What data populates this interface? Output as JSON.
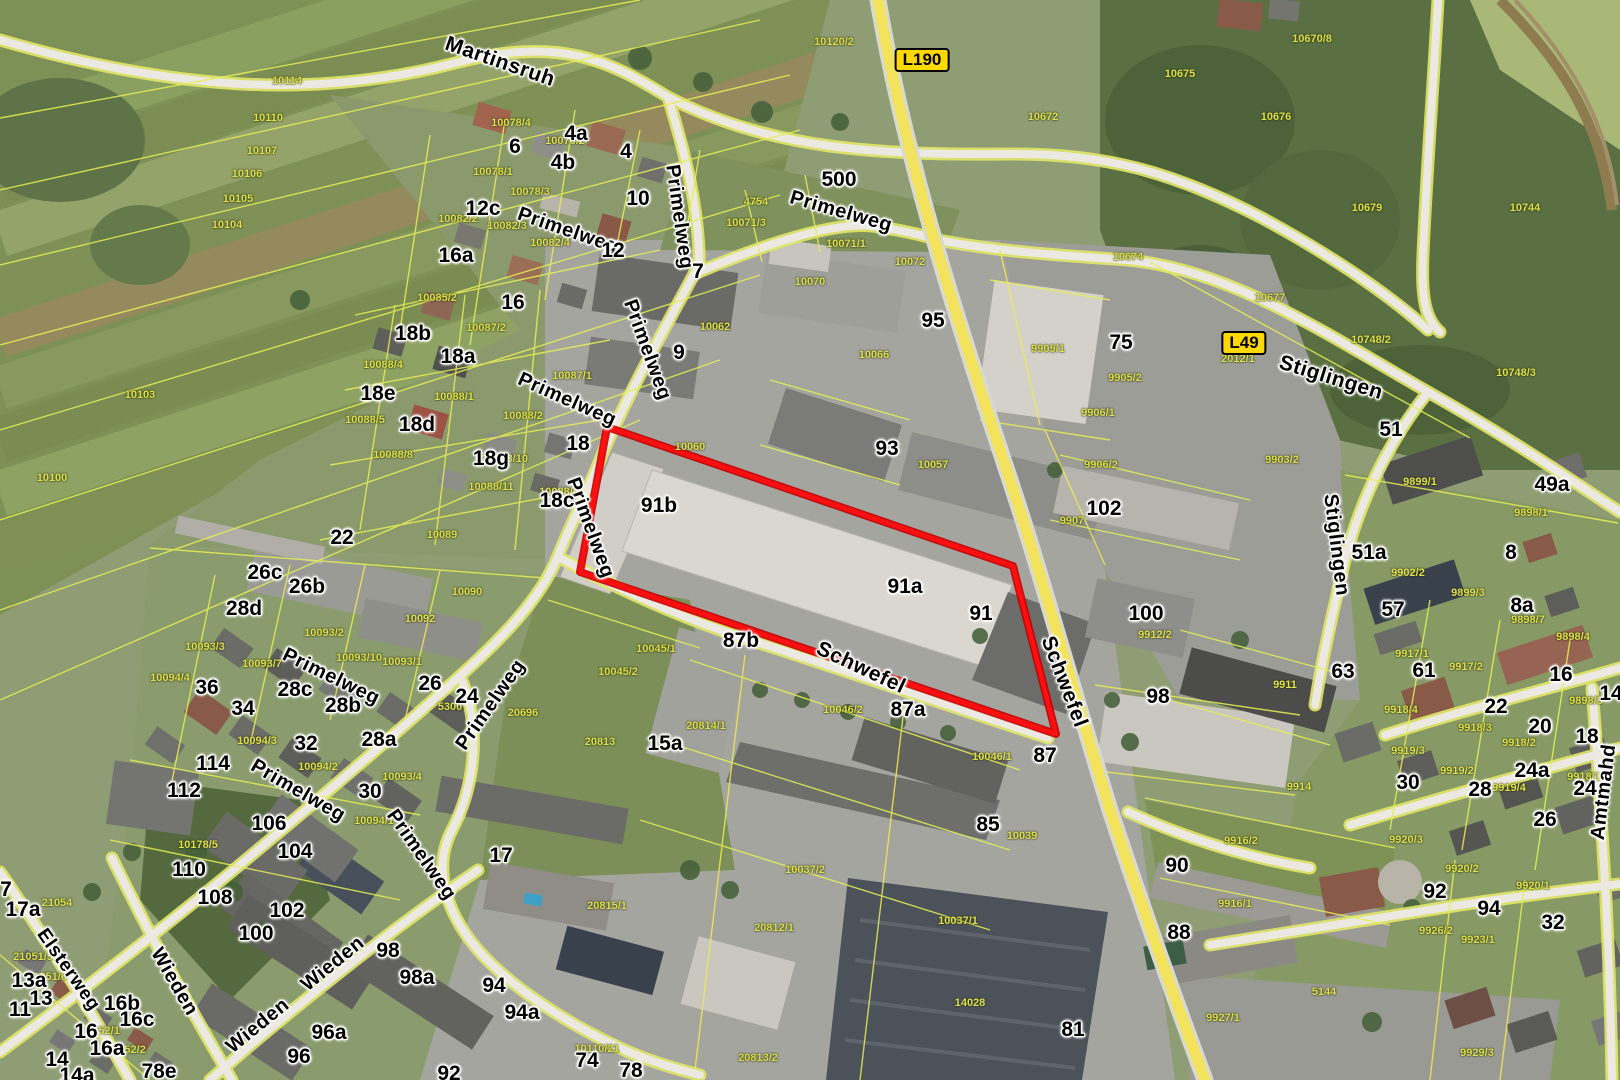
{
  "map": {
    "colors": {
      "cadastral_line": "#e6ee55",
      "red_outline": "#ff0f0f",
      "red_outline_dark": "#c40000",
      "major_road": "#f2e25c",
      "road_badge_bg": "#ffd800",
      "road_badge_text": "#000000",
      "parcel_label": "#dce24f",
      "label_halo": "#ffffff"
    },
    "highlight": {
      "points": "607,427 1013,566 1056,734 580,572"
    },
    "badges": [
      {
        "text": "L190",
        "x": 922,
        "y": 60
      },
      {
        "text": "L49",
        "x": 1244,
        "y": 343
      }
    ],
    "streets": [
      {
        "text": "Martinsruh",
        "x": 500,
        "y": 62,
        "rotate": 19,
        "size": 21
      },
      {
        "text": "Primelweg",
        "x": 568,
        "y": 231,
        "rotate": 19
      },
      {
        "text": "Primelweg",
        "x": 841,
        "y": 212,
        "rotate": 16
      },
      {
        "text": "Primelweg",
        "x": 679,
        "y": 217,
        "rotate": 82
      },
      {
        "text": "Primelweg",
        "x": 647,
        "y": 350,
        "rotate": 70
      },
      {
        "text": "Primelweg",
        "x": 567,
        "y": 400,
        "rotate": 24
      },
      {
        "text": "Primelweg",
        "x": 590,
        "y": 528,
        "rotate": 70
      },
      {
        "text": "Primelweg",
        "x": 331,
        "y": 677,
        "rotate": 26
      },
      {
        "text": "Primelweg",
        "x": 298,
        "y": 791,
        "rotate": 30
      },
      {
        "text": "Primelweg",
        "x": 491,
        "y": 705,
        "rotate": -55
      },
      {
        "text": "Primelweg",
        "x": 421,
        "y": 855,
        "rotate": 55
      },
      {
        "text": "Schwefel",
        "x": 861,
        "y": 668,
        "rotate": 25,
        "size": 21
      },
      {
        "text": "Schwefel",
        "x": 1064,
        "y": 682,
        "rotate": 69,
        "size": 21
      },
      {
        "text": "Stiglingen",
        "x": 1331,
        "y": 378,
        "rotate": 17,
        "size": 21
      },
      {
        "text": "Stiglingen",
        "x": 1336,
        "y": 545,
        "rotate": 83
      },
      {
        "text": "Wieden",
        "x": 174,
        "y": 982,
        "rotate": 60
      },
      {
        "text": "Wieden",
        "x": 258,
        "y": 1026,
        "rotate": -39
      },
      {
        "text": "Wieden",
        "x": 333,
        "y": 964,
        "rotate": -39
      },
      {
        "text": "Elsterweg",
        "x": 68,
        "y": 970,
        "rotate": 55,
        "size": 19
      },
      {
        "text": "Amtmahd",
        "x": 1604,
        "y": 792,
        "rotate": -83
      }
    ],
    "houses": [
      {
        "text": "4a",
        "x": 576,
        "y": 134
      },
      {
        "text": "6",
        "x": 515,
        "y": 147
      },
      {
        "text": "4",
        "x": 626,
        "y": 152
      },
      {
        "text": "4b",
        "x": 563,
        "y": 163
      },
      {
        "text": "10",
        "x": 638,
        "y": 199
      },
      {
        "text": "12c",
        "x": 483,
        "y": 209
      },
      {
        "text": "500",
        "x": 839,
        "y": 180
      },
      {
        "text": "16a",
        "x": 456,
        "y": 256
      },
      {
        "text": "12",
        "x": 613,
        "y": 251
      },
      {
        "text": "7",
        "x": 698,
        "y": 272
      },
      {
        "text": "16",
        "x": 513,
        "y": 303
      },
      {
        "text": "95",
        "x": 933,
        "y": 321
      },
      {
        "text": "75",
        "x": 1121,
        "y": 343
      },
      {
        "text": "9",
        "x": 679,
        "y": 353
      },
      {
        "text": "18b",
        "x": 413,
        "y": 334
      },
      {
        "text": "18a",
        "x": 458,
        "y": 357
      },
      {
        "text": "18e",
        "x": 378,
        "y": 394
      },
      {
        "text": "18d",
        "x": 417,
        "y": 425
      },
      {
        "text": "51",
        "x": 1391,
        "y": 430
      },
      {
        "text": "18g",
        "x": 491,
        "y": 459
      },
      {
        "text": "18",
        "x": 578,
        "y": 444
      },
      {
        "text": "93",
        "x": 887,
        "y": 449
      },
      {
        "text": "18c",
        "x": 557,
        "y": 501
      },
      {
        "text": "91b",
        "x": 659,
        "y": 506
      },
      {
        "text": "102",
        "x": 1104,
        "y": 509
      },
      {
        "text": "22",
        "x": 342,
        "y": 538
      },
      {
        "text": "26c",
        "x": 265,
        "y": 573
      },
      {
        "text": "26b",
        "x": 307,
        "y": 587
      },
      {
        "text": "28d",
        "x": 244,
        "y": 609
      },
      {
        "text": "91a",
        "x": 905,
        "y": 587
      },
      {
        "text": "91",
        "x": 981,
        "y": 614
      },
      {
        "text": "100",
        "x": 1146,
        "y": 614
      },
      {
        "text": "51a",
        "x": 1369,
        "y": 553
      },
      {
        "text": "57",
        "x": 1393,
        "y": 610
      },
      {
        "text": "49a",
        "x": 1552,
        "y": 485
      },
      {
        "text": "8",
        "x": 1511,
        "y": 553
      },
      {
        "text": "8a",
        "x": 1522,
        "y": 606
      },
      {
        "text": "63",
        "x": 1343,
        "y": 672
      },
      {
        "text": "61",
        "x": 1424,
        "y": 671
      },
      {
        "text": "87b",
        "x": 741,
        "y": 641
      },
      {
        "text": "36",
        "x": 207,
        "y": 688
      },
      {
        "text": "34",
        "x": 243,
        "y": 709
      },
      {
        "text": "28c",
        "x": 295,
        "y": 690
      },
      {
        "text": "28b",
        "x": 343,
        "y": 706
      },
      {
        "text": "26",
        "x": 430,
        "y": 684
      },
      {
        "text": "24",
        "x": 467,
        "y": 697
      },
      {
        "text": "98",
        "x": 1158,
        "y": 697
      },
      {
        "text": "22",
        "x": 1496,
        "y": 707
      },
      {
        "text": "16",
        "x": 1561,
        "y": 675
      },
      {
        "text": "14",
        "x": 1611,
        "y": 694
      },
      {
        "text": "20",
        "x": 1540,
        "y": 727
      },
      {
        "text": "18",
        "x": 1587,
        "y": 737
      },
      {
        "text": "87a",
        "x": 908,
        "y": 710
      },
      {
        "text": "87",
        "x": 1045,
        "y": 756
      },
      {
        "text": "32",
        "x": 306,
        "y": 744
      },
      {
        "text": "28a",
        "x": 379,
        "y": 740
      },
      {
        "text": "114",
        "x": 213,
        "y": 764
      },
      {
        "text": "112",
        "x": 184,
        "y": 791
      },
      {
        "text": "30",
        "x": 370,
        "y": 792
      },
      {
        "text": "24a",
        "x": 1532,
        "y": 771
      },
      {
        "text": "24",
        "x": 1585,
        "y": 789
      },
      {
        "text": "30",
        "x": 1408,
        "y": 783
      },
      {
        "text": "28",
        "x": 1480,
        "y": 790
      },
      {
        "text": "26",
        "x": 1545,
        "y": 820
      },
      {
        "text": "15a",
        "x": 665,
        "y": 744
      },
      {
        "text": "85",
        "x": 988,
        "y": 825
      },
      {
        "text": "106",
        "x": 269,
        "y": 824
      },
      {
        "text": "104",
        "x": 295,
        "y": 852
      },
      {
        "text": "110",
        "x": 189,
        "y": 870
      },
      {
        "text": "108",
        "x": 215,
        "y": 898
      },
      {
        "text": "102",
        "x": 287,
        "y": 911
      },
      {
        "text": "100",
        "x": 256,
        "y": 934
      },
      {
        "text": "90",
        "x": 1177,
        "y": 866
      },
      {
        "text": "17",
        "x": 501,
        "y": 856
      },
      {
        "text": "7",
        "x": 6,
        "y": 890
      },
      {
        "text": "17a",
        "x": 23,
        "y": 910
      },
      {
        "text": "92",
        "x": 1435,
        "y": 892
      },
      {
        "text": "94",
        "x": 1489,
        "y": 909
      },
      {
        "text": "88",
        "x": 1179,
        "y": 933
      },
      {
        "text": "98",
        "x": 388,
        "y": 951
      },
      {
        "text": "98a",
        "x": 417,
        "y": 978
      },
      {
        "text": "32",
        "x": 1553,
        "y": 923
      },
      {
        "text": "94",
        "x": 494,
        "y": 986
      },
      {
        "text": "94a",
        "x": 522,
        "y": 1013
      },
      {
        "text": "96a",
        "x": 329,
        "y": 1033
      },
      {
        "text": "13a",
        "x": 29,
        "y": 981
      },
      {
        "text": "13",
        "x": 41,
        "y": 999
      },
      {
        "text": "11",
        "x": 20,
        "y": 1010
      },
      {
        "text": "16b",
        "x": 122,
        "y": 1004
      },
      {
        "text": "16c",
        "x": 137,
        "y": 1020
      },
      {
        "text": "16",
        "x": 86,
        "y": 1032
      },
      {
        "text": "16a",
        "x": 107,
        "y": 1049
      },
      {
        "text": "14",
        "x": 57,
        "y": 1060
      },
      {
        "text": "14a",
        "x": 77,
        "y": 1076
      },
      {
        "text": "78e",
        "x": 159,
        "y": 1072
      },
      {
        "text": "96",
        "x": 299,
        "y": 1057
      },
      {
        "text": "92",
        "x": 449,
        "y": 1074
      },
      {
        "text": "74",
        "x": 587,
        "y": 1061
      },
      {
        "text": "78",
        "x": 631,
        "y": 1071
      },
      {
        "text": "81",
        "x": 1073,
        "y": 1030
      }
    ],
    "parcels": [
      {
        "text": "10114",
        "x": 287,
        "y": 81
      },
      {
        "text": "10110",
        "x": 268,
        "y": 118
      },
      {
        "text": "10107",
        "x": 262,
        "y": 151
      },
      {
        "text": "10106",
        "x": 247,
        "y": 174
      },
      {
        "text": "10105",
        "x": 238,
        "y": 199
      },
      {
        "text": "10104",
        "x": 227,
        "y": 225
      },
      {
        "text": "10103",
        "x": 140,
        "y": 395
      },
      {
        "text": "10100",
        "x": 52,
        "y": 478
      },
      {
        "text": "10120/2",
        "x": 834,
        "y": 42
      },
      {
        "text": "10670/8",
        "x": 1312,
        "y": 39
      },
      {
        "text": "10675",
        "x": 1180,
        "y": 74
      },
      {
        "text": "10676",
        "x": 1276,
        "y": 117
      },
      {
        "text": "10672",
        "x": 1043,
        "y": 117
      },
      {
        "text": "10679",
        "x": 1367,
        "y": 208
      },
      {
        "text": "10744",
        "x": 1525,
        "y": 208
      },
      {
        "text": "10677",
        "x": 1270,
        "y": 298
      },
      {
        "text": "10748/2",
        "x": 1371,
        "y": 340
      },
      {
        "text": "10748/3",
        "x": 1516,
        "y": 373
      },
      {
        "text": "10674",
        "x": 1128,
        "y": 257
      },
      {
        "text": "10078/4",
        "x": 511,
        "y": 123
      },
      {
        "text": "10078/2",
        "x": 565,
        "y": 141
      },
      {
        "text": "10078/1",
        "x": 493,
        "y": 172
      },
      {
        "text": "10078/3",
        "x": 530,
        "y": 192
      },
      {
        "text": "10082/2",
        "x": 458,
        "y": 219
      },
      {
        "text": "10082/3",
        "x": 507,
        "y": 226
      },
      {
        "text": "10082/4",
        "x": 550,
        "y": 243
      },
      {
        "text": "4754",
        "x": 756,
        "y": 202
      },
      {
        "text": "10071/3",
        "x": 746,
        "y": 223
      },
      {
        "text": "10071/1",
        "x": 846,
        "y": 244
      },
      {
        "text": "10072",
        "x": 910,
        "y": 262
      },
      {
        "text": "10070",
        "x": 810,
        "y": 282
      },
      {
        "text": "10085/2",
        "x": 437,
        "y": 298
      },
      {
        "text": "10087/2",
        "x": 486,
        "y": 328
      },
      {
        "text": "10087/1",
        "x": 572,
        "y": 376
      },
      {
        "text": "10088/4",
        "x": 383,
        "y": 365
      },
      {
        "text": "10088/1",
        "x": 454,
        "y": 397
      },
      {
        "text": "10088/2",
        "x": 523,
        "y": 416
      },
      {
        "text": "10088/5",
        "x": 365,
        "y": 420
      },
      {
        "text": "10088/8",
        "x": 393,
        "y": 455
      },
      {
        "text": "10088/10",
        "x": 505,
        "y": 459
      },
      {
        "text": "10088/11",
        "x": 491,
        "y": 487
      },
      {
        "text": "10088/6",
        "x": 559,
        "y": 492
      },
      {
        "text": "10089",
        "x": 442,
        "y": 535
      },
      {
        "text": "10062",
        "x": 715,
        "y": 327
      },
      {
        "text": "10066",
        "x": 874,
        "y": 355
      },
      {
        "text": "10060",
        "x": 690,
        "y": 447
      },
      {
        "text": "10057",
        "x": 933,
        "y": 465
      },
      {
        "text": "9905/1",
        "x": 1048,
        "y": 349
      },
      {
        "text": "9905/2",
        "x": 1125,
        "y": 378
      },
      {
        "text": "2012/1",
        "x": 1238,
        "y": 359
      },
      {
        "text": "9906/1",
        "x": 1098,
        "y": 413
      },
      {
        "text": "9906/2",
        "x": 1101,
        "y": 465
      },
      {
        "text": "9907",
        "x": 1072,
        "y": 521
      },
      {
        "text": "9903/2",
        "x": 1282,
        "y": 460
      },
      {
        "text": "9899/1",
        "x": 1420,
        "y": 482
      },
      {
        "text": "9898/1",
        "x": 1531,
        "y": 513
      },
      {
        "text": "9902/2",
        "x": 1408,
        "y": 573
      },
      {
        "text": "9899/3",
        "x": 1468,
        "y": 593
      },
      {
        "text": "9898/7",
        "x": 1528,
        "y": 620
      },
      {
        "text": "9898/4",
        "x": 1573,
        "y": 637
      },
      {
        "text": "9898/3",
        "x": 1586,
        "y": 701
      },
      {
        "text": "9917/1",
        "x": 1412,
        "y": 654
      },
      {
        "text": "9917/2",
        "x": 1466,
        "y": 667
      },
      {
        "text": "9918/4",
        "x": 1401,
        "y": 710
      },
      {
        "text": "9918/3",
        "x": 1475,
        "y": 728
      },
      {
        "text": "9918/2",
        "x": 1519,
        "y": 743
      },
      {
        "text": "9918/1",
        "x": 1584,
        "y": 777
      },
      {
        "text": "9919/3",
        "x": 1408,
        "y": 751
      },
      {
        "text": "9919/2",
        "x": 1457,
        "y": 771
      },
      {
        "text": "9919/4",
        "x": 1509,
        "y": 788
      },
      {
        "text": "9920/3",
        "x": 1406,
        "y": 840
      },
      {
        "text": "9920/2",
        "x": 1462,
        "y": 869
      },
      {
        "text": "9920/1",
        "x": 1533,
        "y": 886
      },
      {
        "text": "9926/2",
        "x": 1436,
        "y": 931
      },
      {
        "text": "9923/1",
        "x": 1478,
        "y": 940
      },
      {
        "text": "9914",
        "x": 1299,
        "y": 787
      },
      {
        "text": "9916/2",
        "x": 1241,
        "y": 841
      },
      {
        "text": "9916/1",
        "x": 1235,
        "y": 904
      },
      {
        "text": "5144",
        "x": 1324,
        "y": 992
      },
      {
        "text": "9927/1",
        "x": 1223,
        "y": 1018
      },
      {
        "text": "9929/3",
        "x": 1477,
        "y": 1053
      },
      {
        "text": "9912/2",
        "x": 1155,
        "y": 635
      },
      {
        "text": "9911",
        "x": 1285,
        "y": 685
      },
      {
        "text": "10039",
        "x": 1022,
        "y": 836
      },
      {
        "text": "10046/1",
        "x": 992,
        "y": 757
      },
      {
        "text": "10046/2",
        "x": 843,
        "y": 710
      },
      {
        "text": "10037/2",
        "x": 805,
        "y": 870
      },
      {
        "text": "10037/1",
        "x": 958,
        "y": 921
      },
      {
        "text": "20812/1",
        "x": 774,
        "y": 928
      },
      {
        "text": "20814/1",
        "x": 706,
        "y": 726
      },
      {
        "text": "20813",
        "x": 600,
        "y": 742
      },
      {
        "text": "10045/1",
        "x": 656,
        "y": 649
      },
      {
        "text": "10045/2",
        "x": 618,
        "y": 672
      },
      {
        "text": "20815/1",
        "x": 607,
        "y": 906
      },
      {
        "text": "20813/2",
        "x": 758,
        "y": 1058
      },
      {
        "text": "10110/21",
        "x": 597,
        "y": 1049
      },
      {
        "text": "14028",
        "x": 970,
        "y": 1003
      },
      {
        "text": "10090",
        "x": 467,
        "y": 592
      },
      {
        "text": "10092",
        "x": 420,
        "y": 619
      },
      {
        "text": "10093/2",
        "x": 324,
        "y": 633
      },
      {
        "text": "10093/10",
        "x": 359,
        "y": 658
      },
      {
        "text": "10093/1",
        "x": 402,
        "y": 662
      },
      {
        "text": "10093/7",
        "x": 262,
        "y": 664
      },
      {
        "text": "10093/3",
        "x": 205,
        "y": 647
      },
      {
        "text": "10094/4",
        "x": 170,
        "y": 678
      },
      {
        "text": "10094/3",
        "x": 257,
        "y": 741
      },
      {
        "text": "10094/2",
        "x": 318,
        "y": 767
      },
      {
        "text": "10093/4",
        "x": 402,
        "y": 777
      },
      {
        "text": "10094/1",
        "x": 374,
        "y": 821
      },
      {
        "text": "20696",
        "x": 523,
        "y": 713
      },
      {
        "text": "5300",
        "x": 450,
        "y": 707
      },
      {
        "text": "21054",
        "x": 57,
        "y": 903
      },
      {
        "text": "21051/5",
        "x": 33,
        "y": 957
      },
      {
        "text": "21051/6",
        "x": 47,
        "y": 977
      },
      {
        "text": "1052/1",
        "x": 103,
        "y": 1031
      },
      {
        "text": "1052/2",
        "x": 129,
        "y": 1050
      },
      {
        "text": "10178/5",
        "x": 198,
        "y": 845
      }
    ]
  }
}
